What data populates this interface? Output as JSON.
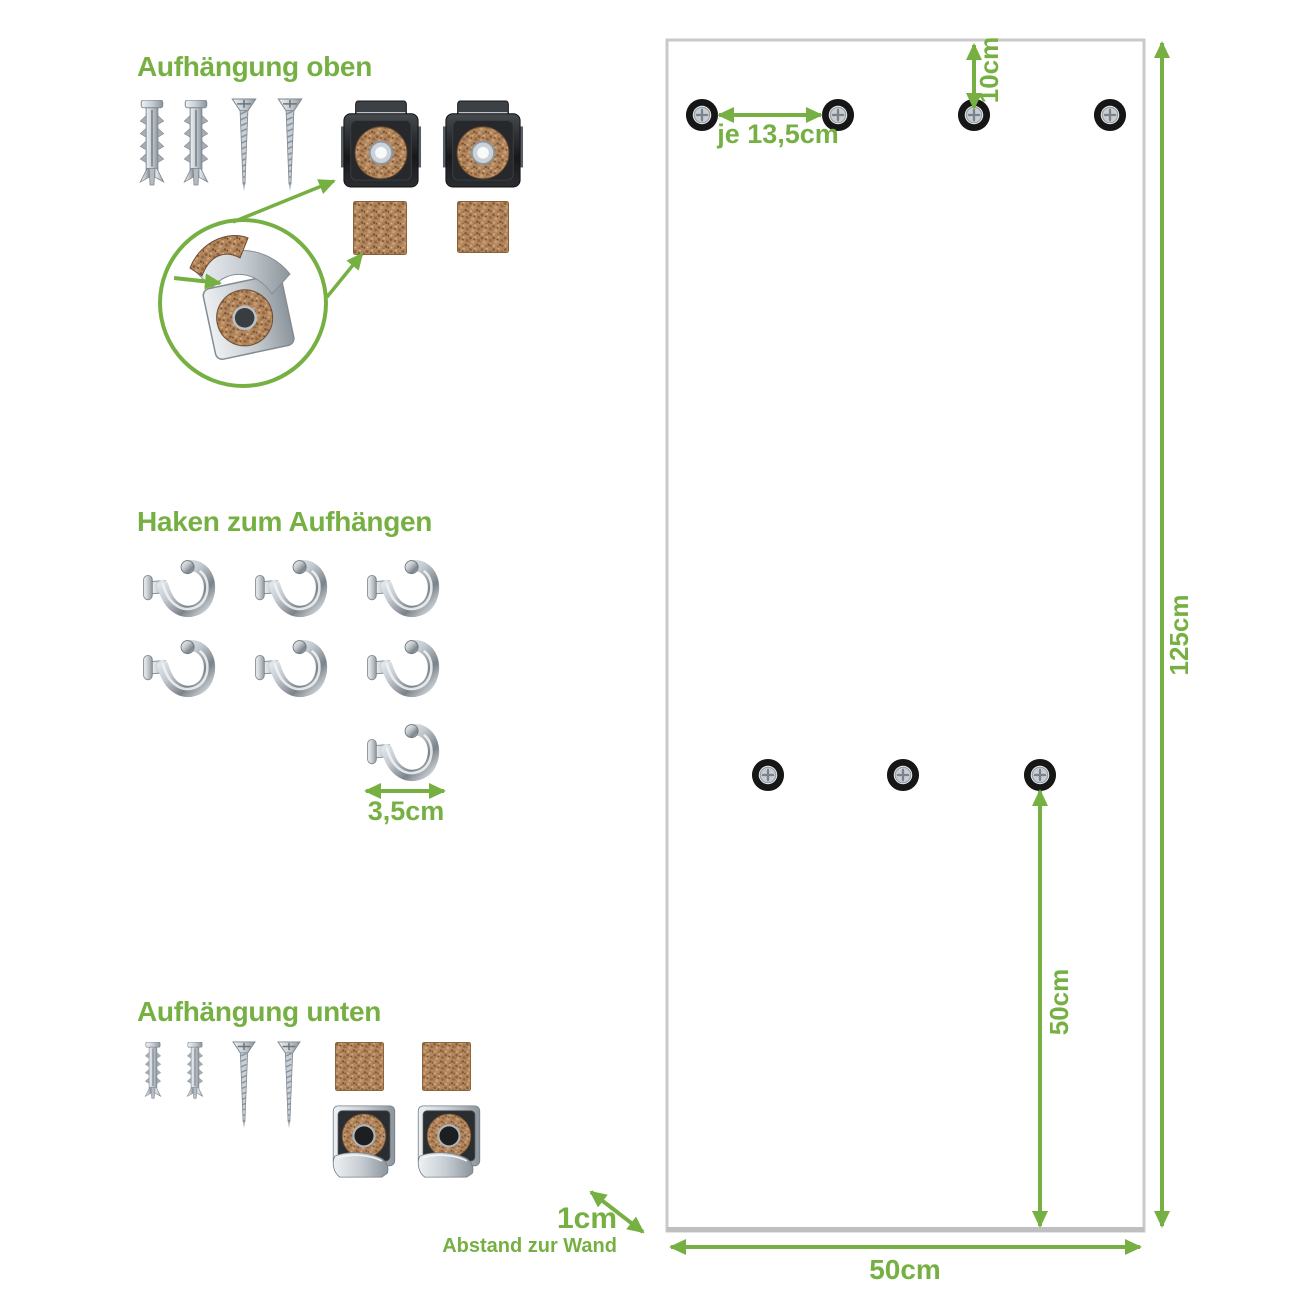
{
  "colors": {
    "accent_green": "#76b043",
    "panel_border": "#c9c9c9",
    "cork_brown": "#b2865e",
    "metal_silver": "#c9d0d6",
    "clip_dark": "#26282b",
    "washer_black": "#141414"
  },
  "sections": {
    "top_mount": {
      "title": "Aufhängung oben"
    },
    "hooks": {
      "title": "Haken zum Aufhängen",
      "spacing_label": "3,5cm"
    },
    "bottom_mount": {
      "title": "Aufhängung unten"
    }
  },
  "panel": {
    "width_label": "50cm",
    "height_label": "125cm",
    "top_offset_label": "10cm",
    "hole_spacing_label": "je 13,5cm",
    "mid_height_label": "50cm",
    "wall_gap_label": "1cm",
    "wall_gap_caption": "Abstand zur Wand"
  }
}
